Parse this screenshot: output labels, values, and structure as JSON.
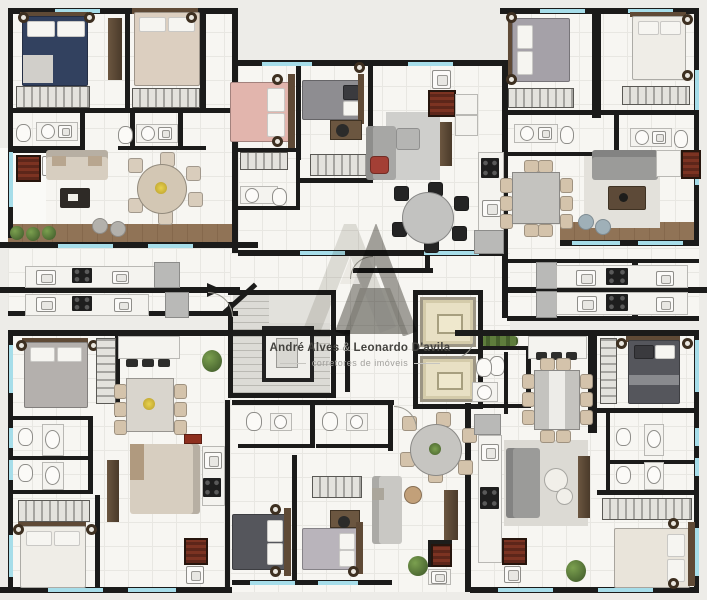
{
  "watermark": {
    "name_left": "André Alves",
    "ampersand": "&",
    "name_right": "Leonardo D'avila",
    "tagline": "corretores de imóveis"
  },
  "palette": {
    "background": "#edece8",
    "floor": "#f7f6f2",
    "floor_grid": "#e8e7e2",
    "wall": "#1b1b1a",
    "window": "#a6dde9",
    "wood_deck": "#8a6e52",
    "furniture_wood": "#5f4a36",
    "counter": "#f4f3ef",
    "appliance": "#1e1e1e",
    "fridge": "#b9b9b7",
    "washer": "#7c3322",
    "plant": "#5e7d3c",
    "elevator_cab": "#e8e0c4",
    "stair": "#dcdbd6",
    "stair_tread": "#bab9b3",
    "rug": "#dddcd7",
    "sofa_beige": "#d7cec0",
    "sofa_gray": "#9b9b99",
    "bed_navy": "#32415f",
    "bed_white": "#efede7",
    "bed_beige": "#dccfc0",
    "bed_pink": "#e2b5ad",
    "bed_gray": "#a5a1a8",
    "bed_dark": "#55565c",
    "wardrobe_stripe": "#a5a4a0",
    "watermark_light": "#d8d7d4",
    "watermark_dark": "#716f68",
    "watermark_text": "#44433f",
    "watermark_tagline": "#a09f9b"
  }
}
